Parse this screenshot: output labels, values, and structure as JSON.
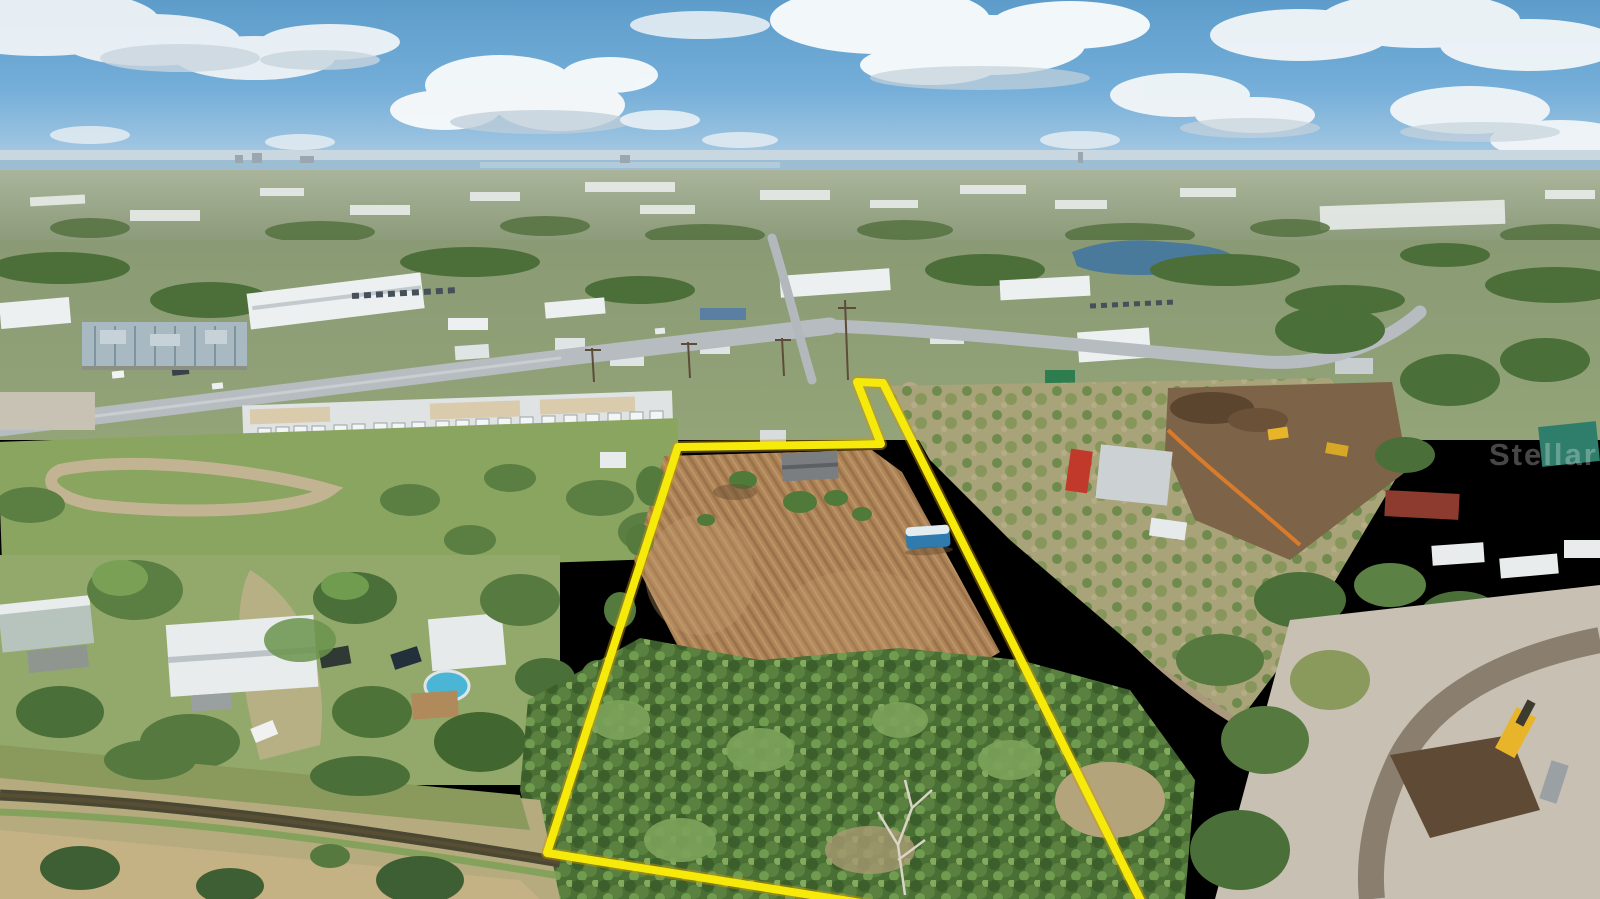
{
  "scene": {
    "type": "aerial-drone-photograph",
    "description": "Aerial drone photo of a vacant flag-shaped land parcel outlined in yellow: a plowed brown field with a camper trailer, dense woods and a drainage canal along the south edge, an RV-storage yard and electrical substation to the northwest, homes with a pool to the west, light-industrial buildings to the north, scrub land and active dirt construction sites to the east, all under a partly cloudy blue sky with a hazy coastal horizon.",
    "palette": {
      "sky_blue": "#6aa7d4",
      "cloud_white": "#f4f7f9",
      "haze": "#c9d7e0",
      "water_strip": "#9dbdd3",
      "distant_land": "#98a688",
      "tree_green_dark": "#3e5f33",
      "tree_green_mid": "#5b7f42",
      "tree_green_light": "#7ca35a",
      "grass_green": "#8aa55f",
      "dry_grass_tan": "#c4b184",
      "field_brown": "#b3895c",
      "road_gray": "#b7bcc0",
      "roof_white": "#eef1f2",
      "construction_brown": "#7d6347",
      "cleared_gray": "#c7c0b3",
      "canal_water": "#4a4733",
      "pool_blue": "#4ab5d5"
    }
  },
  "watermark": {
    "text": "Stellar MLS",
    "visible_portion": "Stellar M",
    "clipped_at_right_edge": true,
    "color": "#ffffff",
    "opacity": 0.28,
    "x": 1489,
    "y": 465,
    "font_size": 31
  },
  "boundary": {
    "label": "property-boundary-outline",
    "color": "#f6ea0b",
    "underglow_color": "#cf9a00",
    "stroke_width": 8,
    "points": [
      [
        857,
        382
      ],
      [
        883,
        383
      ],
      [
        1148,
        915
      ],
      [
        918,
        912
      ],
      [
        547,
        853
      ],
      [
        678,
        447
      ],
      [
        881,
        444
      ]
    ]
  }
}
